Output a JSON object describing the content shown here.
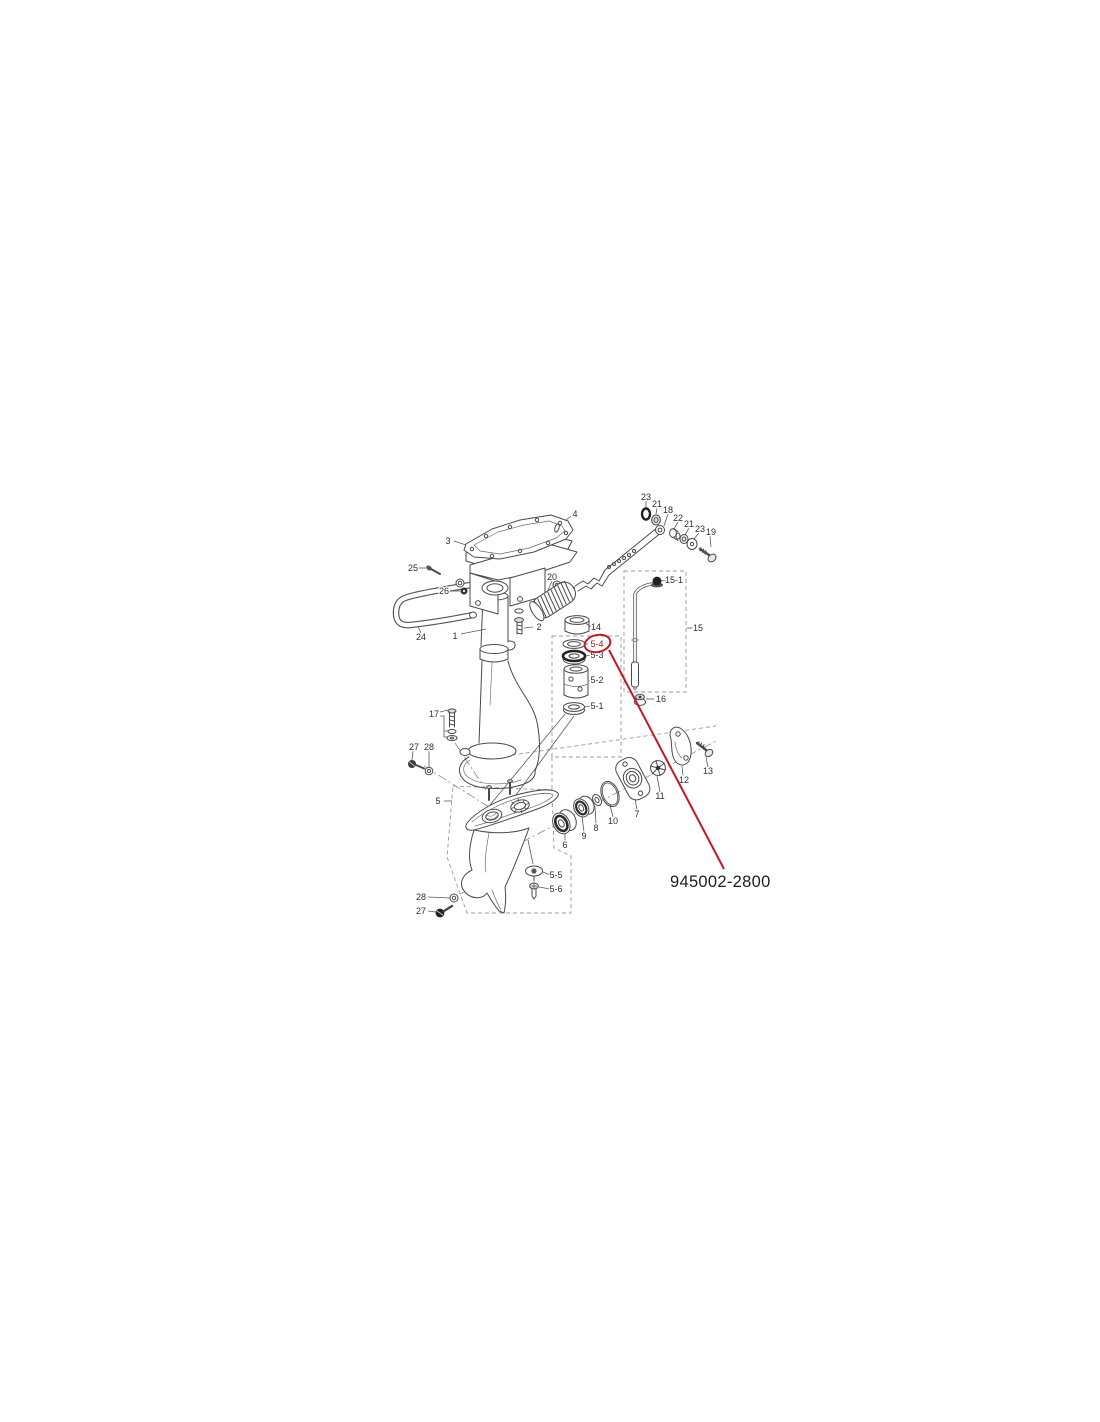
{
  "page": {
    "background_color": "#ffffff"
  },
  "callout": {
    "part_number": "945002-2800",
    "color": "#c11a24",
    "circled_label": "5-4",
    "circled_label_color": "#9c2020"
  },
  "diagram": {
    "type": "exploded-parts-diagram",
    "subject": "outboard-motor-driveshaft-housing-and-gearcase",
    "labels": [
      {
        "text": "1",
        "x": 455,
        "y": 636
      },
      {
        "text": "2",
        "x": 539,
        "y": 627
      },
      {
        "text": "3",
        "x": 448,
        "y": 541
      },
      {
        "text": "4",
        "x": 575,
        "y": 514
      },
      {
        "text": "5",
        "x": 438,
        "y": 801
      },
      {
        "text": "5-1",
        "x": 597,
        "y": 706
      },
      {
        "text": "5-2",
        "x": 597,
        "y": 680
      },
      {
        "text": "5-3",
        "x": 597,
        "y": 655
      },
      {
        "text": "5-4",
        "x": 597,
        "y": 644,
        "color": "#9c2020"
      },
      {
        "text": "5-5",
        "x": 556,
        "y": 875
      },
      {
        "text": "5-6",
        "x": 556,
        "y": 889
      },
      {
        "text": "6",
        "x": 565,
        "y": 845
      },
      {
        "text": "7",
        "x": 637,
        "y": 814
      },
      {
        "text": "8",
        "x": 596,
        "y": 828
      },
      {
        "text": "9",
        "x": 584,
        "y": 836
      },
      {
        "text": "10",
        "x": 613,
        "y": 821
      },
      {
        "text": "11",
        "x": 660,
        "y": 796
      },
      {
        "text": "12",
        "x": 684,
        "y": 780
      },
      {
        "text": "13",
        "x": 708,
        "y": 771
      },
      {
        "text": "14",
        "x": 596,
        "y": 627
      },
      {
        "text": "15",
        "x": 698,
        "y": 628
      },
      {
        "text": "15-1",
        "x": 674,
        "y": 580
      },
      {
        "text": "16",
        "x": 661,
        "y": 699
      },
      {
        "text": "17",
        "x": 434,
        "y": 714
      },
      {
        "text": "18",
        "x": 668,
        "y": 510
      },
      {
        "text": "19",
        "x": 711,
        "y": 532
      },
      {
        "text": "20",
        "x": 552,
        "y": 577
      },
      {
        "text": "21",
        "x": 657,
        "y": 504
      },
      {
        "text": "21",
        "x": 689,
        "y": 524
      },
      {
        "text": "22",
        "x": 678,
        "y": 518
      },
      {
        "text": "23",
        "x": 646,
        "y": 497
      },
      {
        "text": "23",
        "x": 700,
        "y": 529
      },
      {
        "text": "24",
        "x": 421,
        "y": 637
      },
      {
        "text": "25",
        "x": 413,
        "y": 568
      },
      {
        "text": "26",
        "x": 444,
        "y": 591
      },
      {
        "text": "27",
        "x": 414,
        "y": 747
      },
      {
        "text": "27",
        "x": 421,
        "y": 911
      },
      {
        "text": "28",
        "x": 429,
        "y": 747
      },
      {
        "text": "28",
        "x": 421,
        "y": 897
      }
    ]
  }
}
